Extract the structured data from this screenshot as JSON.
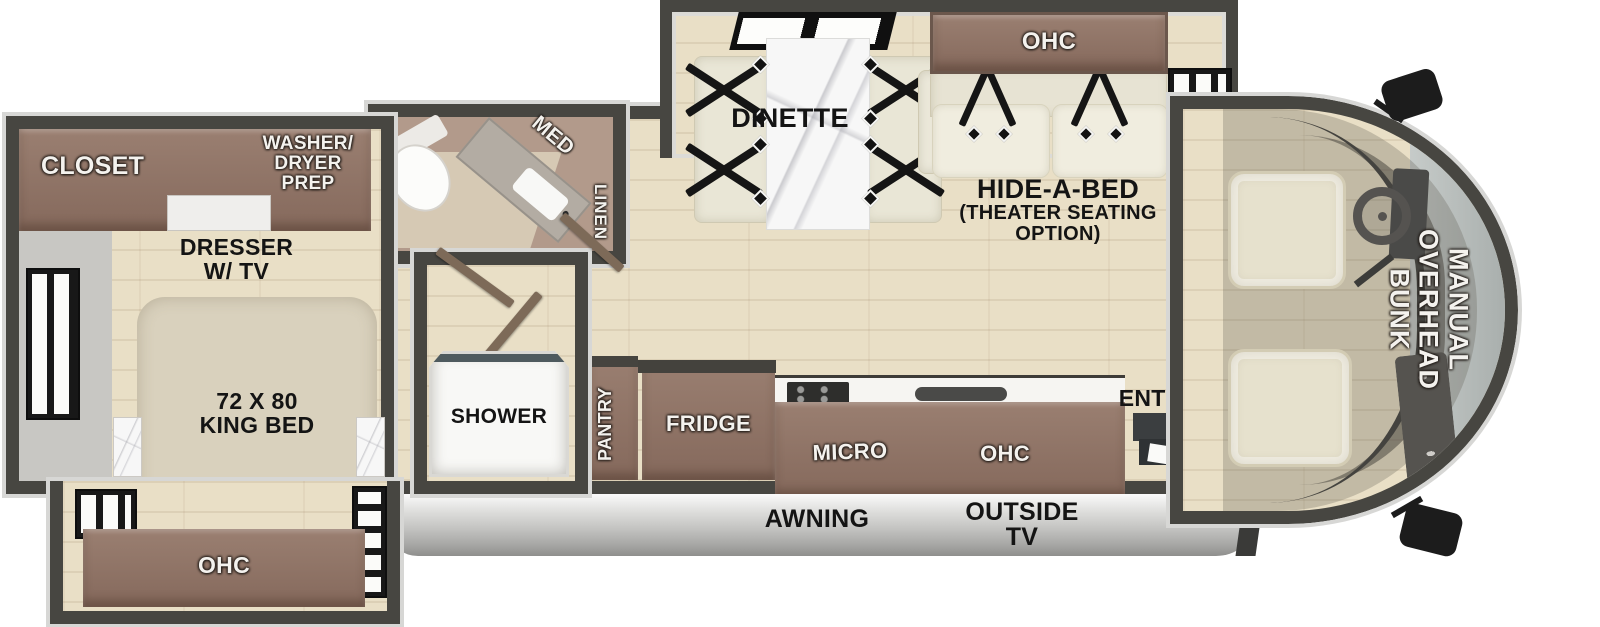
{
  "bedroom": {
    "closet_label": "CLOSET",
    "washer_dryer_prep": [
      "WASHER/",
      "DRYER",
      "PREP"
    ],
    "dresser_tv": [
      "DRESSER",
      "W/ TV"
    ],
    "king_bed": [
      "72 X 80",
      "KING BED"
    ],
    "ohc_label": "OHC"
  },
  "bathroom": {
    "med_label": "MED",
    "linen_label": "LINEN"
  },
  "shower": {
    "label": "SHOWER"
  },
  "kitchen": {
    "pantry_label": "PANTRY",
    "fridge_label": "FRIDGE",
    "micro_label": "MICRO",
    "ohc_label": "OHC"
  },
  "dinette": {
    "label": "DINETTE"
  },
  "sofa": {
    "ohc_label": "OHC",
    "hide_a_bed": [
      "HIDE-A-BED",
      "(THEATER SEATING",
      "OPTION)"
    ]
  },
  "cab": {
    "overhead_bunk": [
      "MANUAL",
      "OVERHEAD",
      "BUNK"
    ],
    "entry_label": "ENTRY"
  },
  "exterior": {
    "awning_label": "AWNING",
    "outside_tv": [
      "OUTSIDE",
      "TV"
    ]
  },
  "colors": {
    "wall": "#474641",
    "wall_outline": "#d7d7d5",
    "floor": "#e9dfc6",
    "floor_shade": "#c8c7c3",
    "cabinet": "#8e7467",
    "cabinet_dark": "#6e5a4f",
    "bath_floor": "#b29a8b",
    "fixture": "#f8f8f6",
    "bed": "#d9d1bd",
    "bench": "#e9e6d6",
    "cushion": "#f0eddf",
    "marble": "#f7f7f7",
    "glass": "#b9bebc",
    "awning": "#c6c6c4",
    "black": "#151515",
    "label_white": "#f4f2ee",
    "label_black": "#141414"
  }
}
